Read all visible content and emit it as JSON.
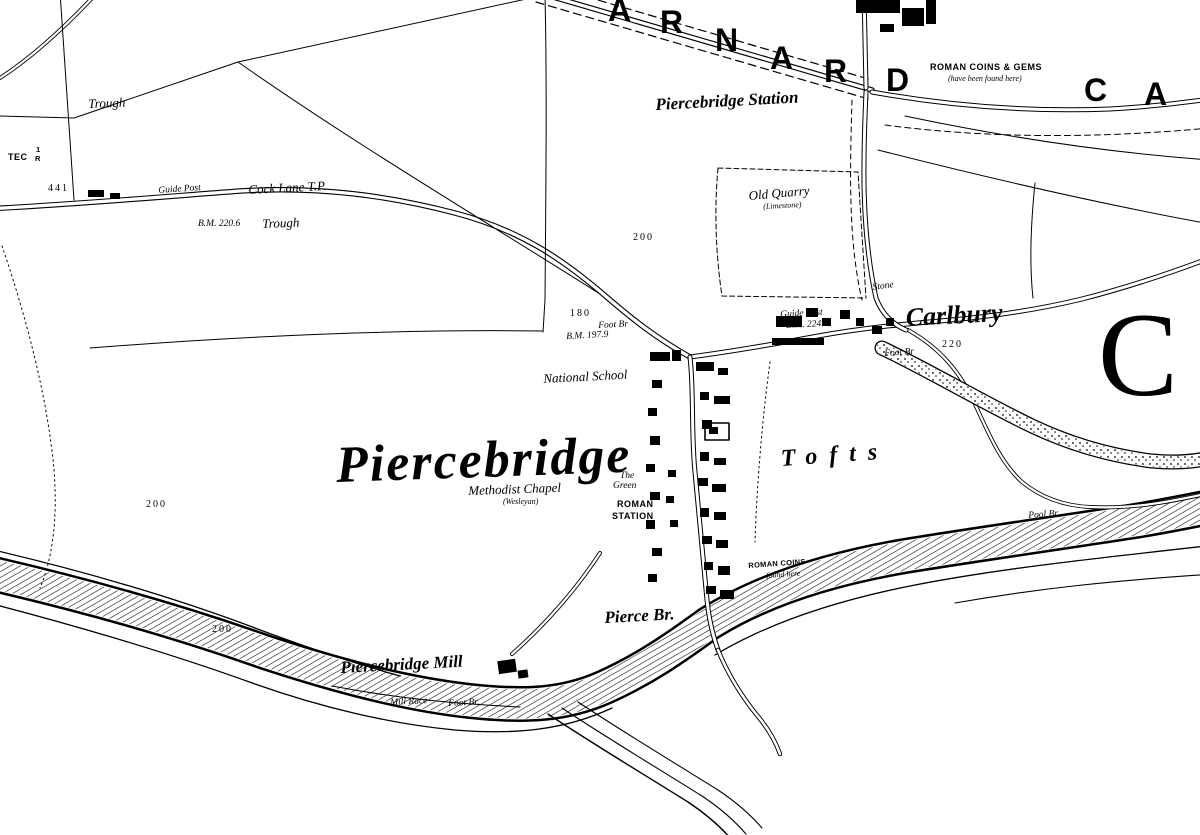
{
  "colors": {
    "ink": "#000000",
    "paper": "#ffffff"
  },
  "labels": [
    {
      "name": "label-trough-nw",
      "text": "Trough",
      "x": 88,
      "y": 96,
      "cls": "sm",
      "rot": -2
    },
    {
      "name": "label-tec",
      "text": "TEC",
      "x": 8,
      "y": 152,
      "cls": "caps",
      "rot": 0
    },
    {
      "name": "label-tec-frac-1",
      "text": "1",
      "x": 36,
      "y": 145,
      "cls": "capsxs",
      "rot": 0
    },
    {
      "name": "label-tec-frac-r",
      "text": "R",
      "x": 35,
      "y": 154,
      "cls": "capsxs",
      "rot": 0
    },
    {
      "name": "label-spot-441",
      "text": "441",
      "x": 48,
      "y": 183,
      "cls": "num",
      "rot": 0
    },
    {
      "name": "label-guide-post-w",
      "text": "Guide Post",
      "x": 158,
      "y": 186,
      "cls": "xs",
      "rot": -4
    },
    {
      "name": "label-cock-lane-tp",
      "text": "Cock Lane T.P.",
      "x": 248,
      "y": 182,
      "cls": "sm",
      "rot": -3
    },
    {
      "name": "label-bm-220",
      "text": "B.M. 220.6",
      "x": 198,
      "y": 219,
      "cls": "xs",
      "rot": 0
    },
    {
      "name": "label-trough-w",
      "text": "Trough",
      "x": 262,
      "y": 216,
      "cls": "sm",
      "rot": -2
    },
    {
      "name": "label-piercebridge-station",
      "text": "Piercebridge Station",
      "x": 655,
      "y": 95,
      "cls": "pl-md",
      "rot": -3
    },
    {
      "name": "label-roman-coins-gems",
      "text": "ROMAN COINS & GEMS",
      "x": 930,
      "y": 62,
      "cls": "caps",
      "rot": 0
    },
    {
      "name": "label-found-here-ne",
      "text": "(have been found here)",
      "x": 948,
      "y": 74,
      "cls": "tiny-i",
      "rot": 0
    },
    {
      "name": "label-contour-200-ne",
      "text": "200",
      "x": 633,
      "y": 232,
      "cls": "num",
      "rot": 0
    },
    {
      "name": "label-old-quarry",
      "text": "Old Quarry",
      "x": 748,
      "y": 188,
      "cls": "sm",
      "rot": -5
    },
    {
      "name": "label-limestone",
      "text": "(Limestone)",
      "x": 763,
      "y": 202,
      "cls": "tiny-i",
      "rot": -3
    },
    {
      "name": "label-stone",
      "text": "Stone",
      "x": 872,
      "y": 283,
      "cls": "xs",
      "rot": -8
    },
    {
      "name": "label-guide-post-e",
      "text": "Guide Post",
      "x": 780,
      "y": 310,
      "cls": "xs",
      "rot": -3
    },
    {
      "name": "label-bm-carlbury",
      "text": "B.M. 224.6",
      "x": 786,
      "y": 321,
      "cls": "xs",
      "rot": -3
    },
    {
      "name": "label-carlbury",
      "text": "Carlbury",
      "x": 905,
      "y": 303,
      "cls": "pl-lg",
      "rot": -3
    },
    {
      "name": "label-spot-220",
      "text": "220",
      "x": 942,
      "y": 339,
      "cls": "num",
      "rot": 0
    },
    {
      "name": "label-foot-br-carlbury",
      "text": "Foot Br",
      "x": 884,
      "y": 349,
      "cls": "xs",
      "rot": -4
    },
    {
      "name": "label-tofts",
      "text": "Tofts",
      "x": 780,
      "y": 446,
      "cls": "pl-sp",
      "rot": -4
    },
    {
      "name": "label-spot-180",
      "text": "180",
      "x": 570,
      "y": 308,
      "cls": "num",
      "rot": 0
    },
    {
      "name": "label-foot-br-n",
      "text": "Foot Br",
      "x": 598,
      "y": 321,
      "cls": "xs",
      "rot": -3
    },
    {
      "name": "label-bm-197",
      "text": "B.M. 197.9",
      "x": 566,
      "y": 332,
      "cls": "xs",
      "rot": -3
    },
    {
      "name": "label-national-school",
      "text": "National School",
      "x": 543,
      "y": 371,
      "cls": "sm",
      "rot": -3
    },
    {
      "name": "label-piercebridge",
      "text": "Piercebridge",
      "x": 335,
      "y": 436,
      "cls": "pl-xl",
      "rot": -2
    },
    {
      "name": "label-methodist-chapel",
      "text": "Methodist Chapel",
      "x": 468,
      "y": 483,
      "cls": "sm",
      "rot": -2
    },
    {
      "name": "label-wesleyan",
      "text": "(Wesleyan)",
      "x": 503,
      "y": 497,
      "cls": "tiny-i",
      "rot": 0
    },
    {
      "name": "label-the",
      "text": "The",
      "x": 620,
      "y": 471,
      "cls": "xs",
      "rot": 0
    },
    {
      "name": "label-green",
      "text": "Green",
      "x": 613,
      "y": 481,
      "cls": "xs",
      "rot": 0
    },
    {
      "name": "label-roman",
      "text": "ROMAN",
      "x": 617,
      "y": 499,
      "cls": "caps",
      "rot": 0
    },
    {
      "name": "label-station-caps",
      "text": "STATION",
      "x": 612,
      "y": 511,
      "cls": "caps",
      "rot": 0
    },
    {
      "name": "label-contour-200-w",
      "text": "200",
      "x": 146,
      "y": 499,
      "cls": "num",
      "rot": 0
    },
    {
      "name": "label-contour-200-sw",
      "text": "200",
      "x": 212,
      "y": 624,
      "cls": "num",
      "rot": 0
    },
    {
      "name": "label-roman-coins-s",
      "text": "ROMAN COINS",
      "x": 748,
      "y": 561,
      "cls": "capsxs",
      "rot": -4
    },
    {
      "name": "label-found-here-s",
      "text": "found here",
      "x": 766,
      "y": 571,
      "cls": "tiny-i",
      "rot": -4
    },
    {
      "name": "label-pierce-br",
      "text": "Pierce Br.",
      "x": 604,
      "y": 608,
      "cls": "pl-md",
      "rot": -3
    },
    {
      "name": "label-piercebridge-mill",
      "text": "Piercebridge Mill",
      "x": 340,
      "y": 658,
      "cls": "pl-md",
      "rot": -3
    },
    {
      "name": "label-mill-race",
      "text": "Mill Race",
      "x": 390,
      "y": 698,
      "cls": "xs",
      "rot": -3
    },
    {
      "name": "label-foot-br-s",
      "text": "Foot Br.",
      "x": 448,
      "y": 699,
      "cls": "xs",
      "rot": -3
    },
    {
      "name": "label-pool-br",
      "text": "Pool Br.",
      "x": 1028,
      "y": 511,
      "cls": "xs",
      "rot": -4
    }
  ],
  "large_letters": [
    {
      "name": "district-letter-a1",
      "text": "A",
      "x": 608,
      "y": -8,
      "cls": "letter",
      "rot": 0
    },
    {
      "name": "district-letter-r1",
      "text": "R",
      "x": 660,
      "y": 4,
      "cls": "letter",
      "rot": 0
    },
    {
      "name": "district-letter-n",
      "text": "N",
      "x": 715,
      "y": 22,
      "cls": "letter",
      "rot": 0
    },
    {
      "name": "district-letter-a2",
      "text": "A",
      "x": 770,
      "y": 40,
      "cls": "letter",
      "rot": 0
    },
    {
      "name": "district-letter-r2",
      "text": "R",
      "x": 824,
      "y": 53,
      "cls": "letter",
      "rot": 0
    },
    {
      "name": "district-letter-d",
      "text": "D",
      "x": 886,
      "y": 62,
      "cls": "letter",
      "rot": 0
    },
    {
      "name": "district-letter-c",
      "text": "C",
      "x": 1084,
      "y": 72,
      "cls": "letter",
      "rot": 0
    },
    {
      "name": "district-letter-a3",
      "text": "A",
      "x": 1144,
      "y": 76,
      "cls": "letter",
      "rot": 0
    },
    {
      "name": "district-letter-c-huge",
      "text": "C",
      "x": 1098,
      "y": 286,
      "cls": "letter-huge",
      "rot": 0
    }
  ]
}
